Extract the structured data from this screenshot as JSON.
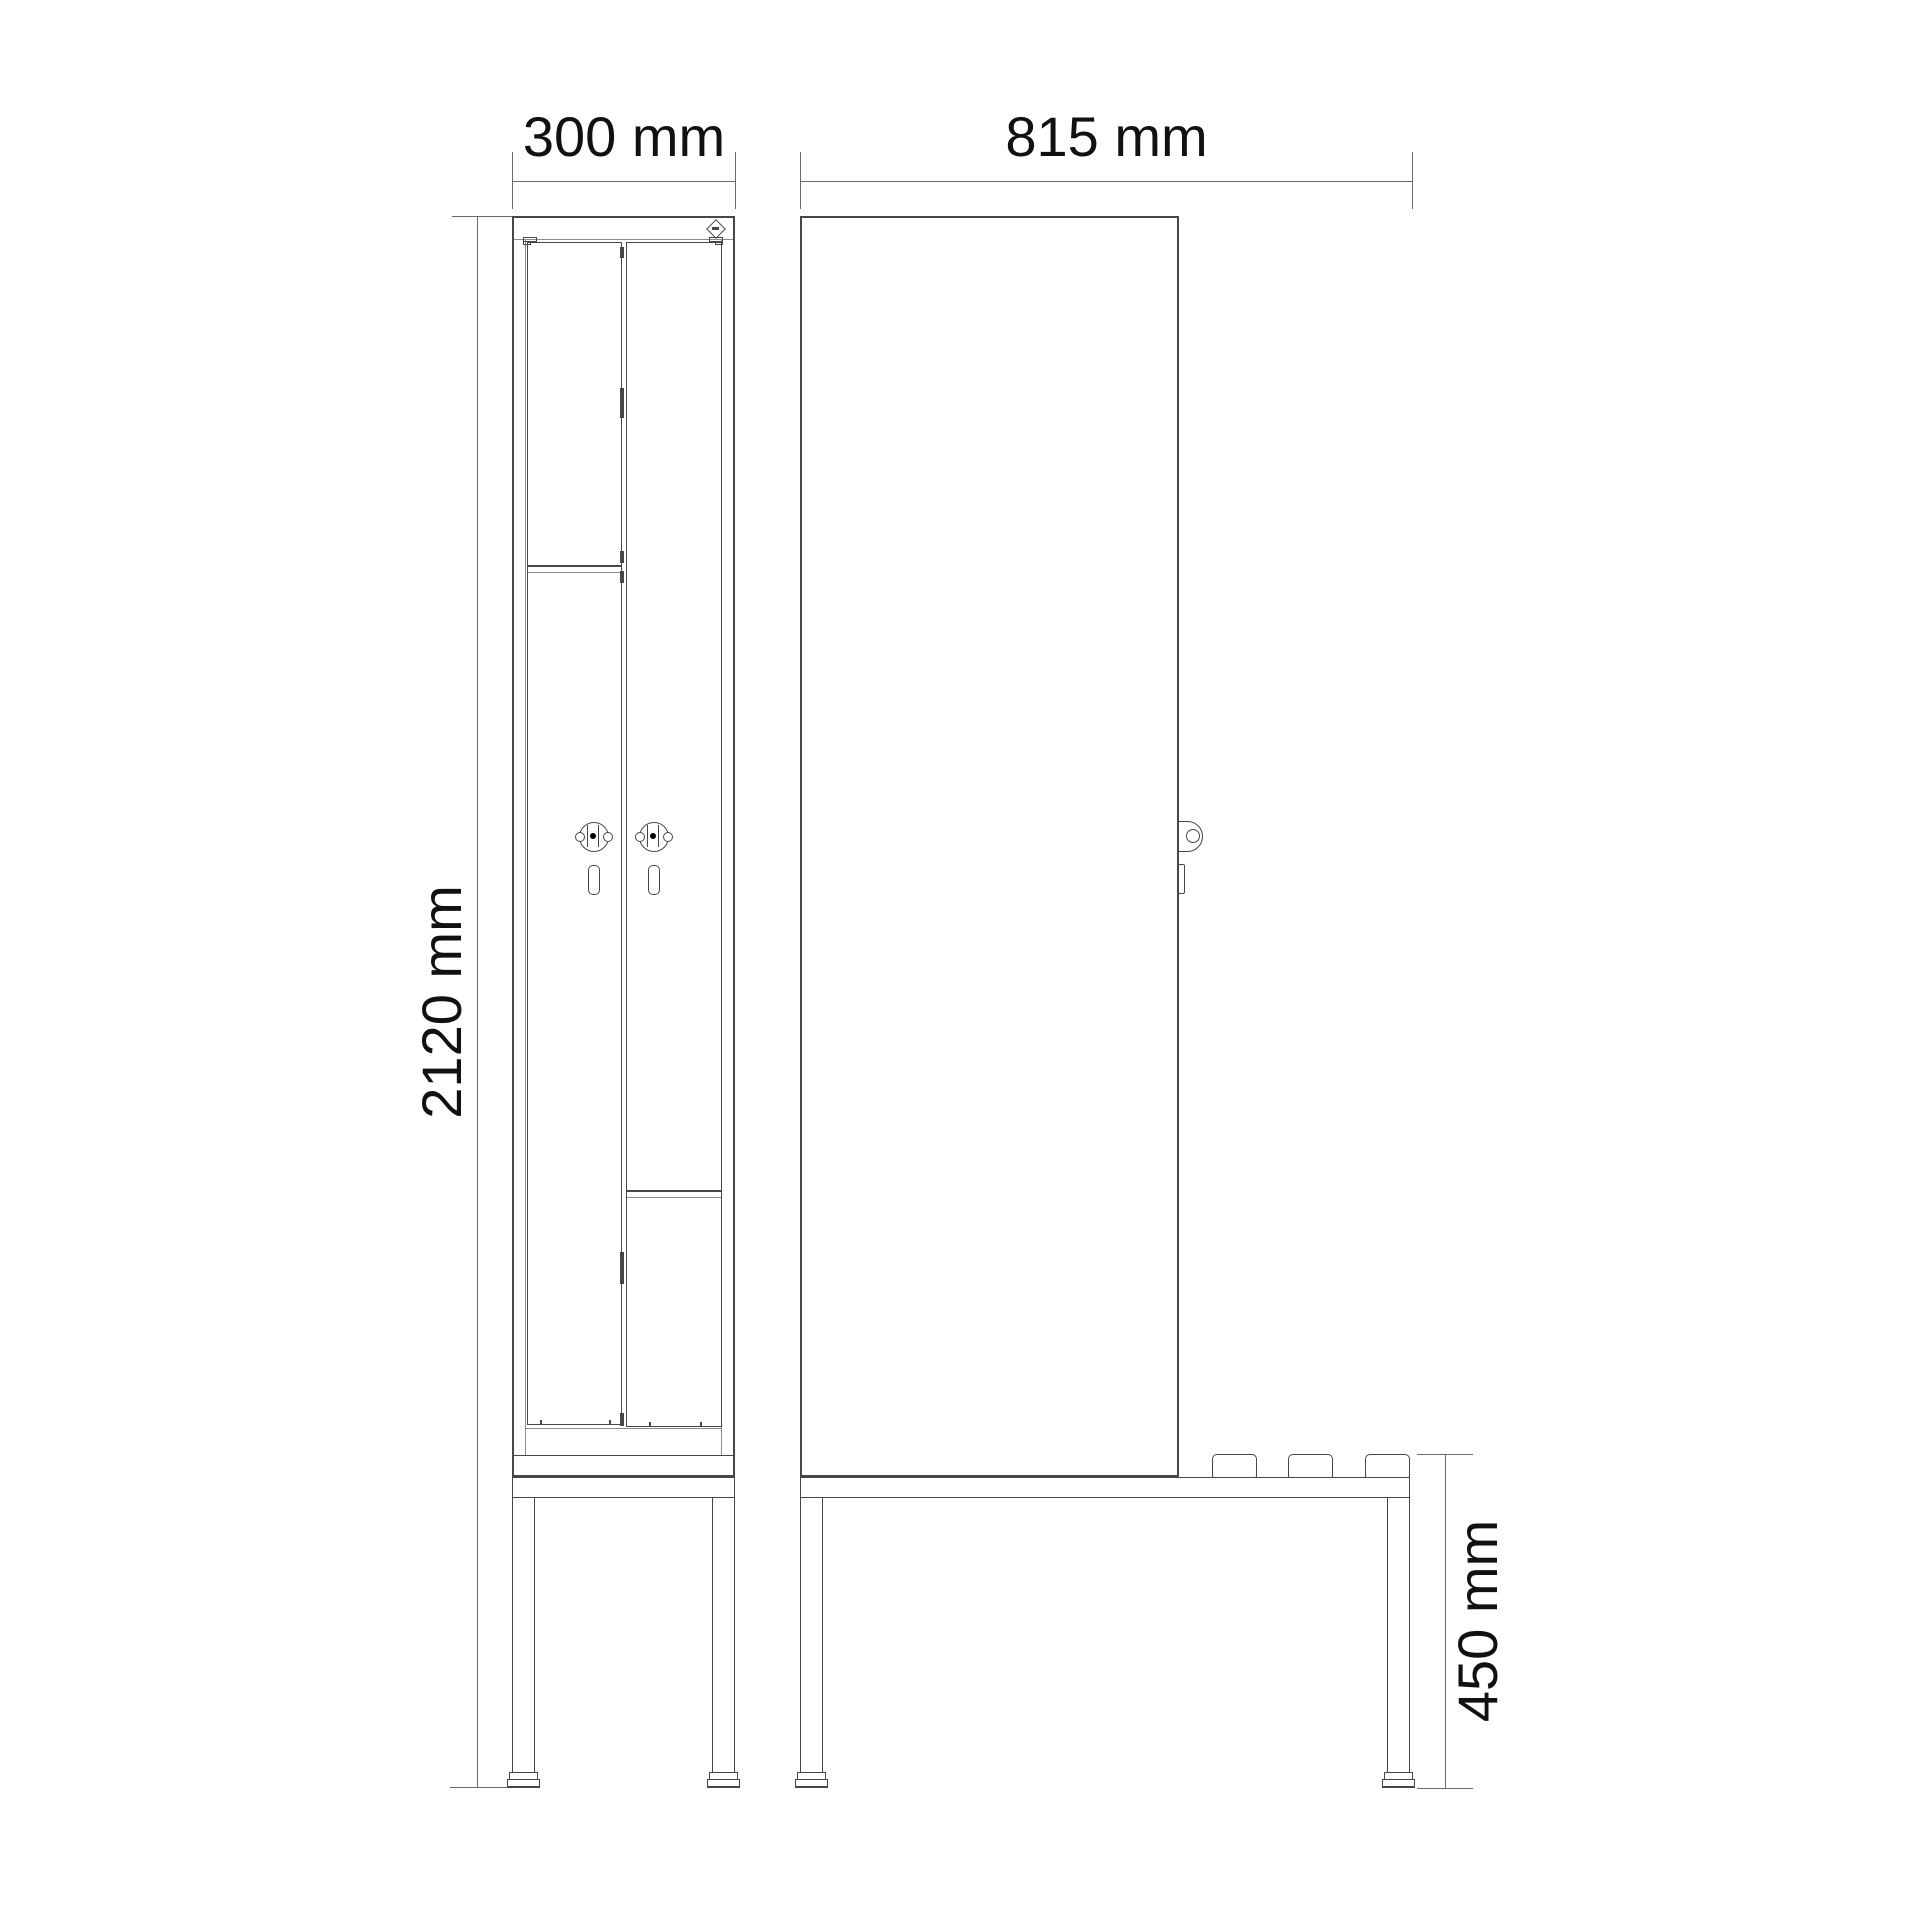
{
  "dimensions": {
    "front_width": "300 mm",
    "overall_height": "2120 mm",
    "side_depth": "815 mm",
    "bench_height": "450 mm"
  },
  "icons": {
    "brand_logo": "diamond-logo-icon",
    "lock": "cylinder-lock-icon",
    "handle": "handle-slot-icon"
  },
  "colors": {
    "bg": "#ffffff",
    "line": "#474747",
    "thin": "#8c8c8c",
    "dim": "#6a6a6a",
    "text": "#111111"
  }
}
